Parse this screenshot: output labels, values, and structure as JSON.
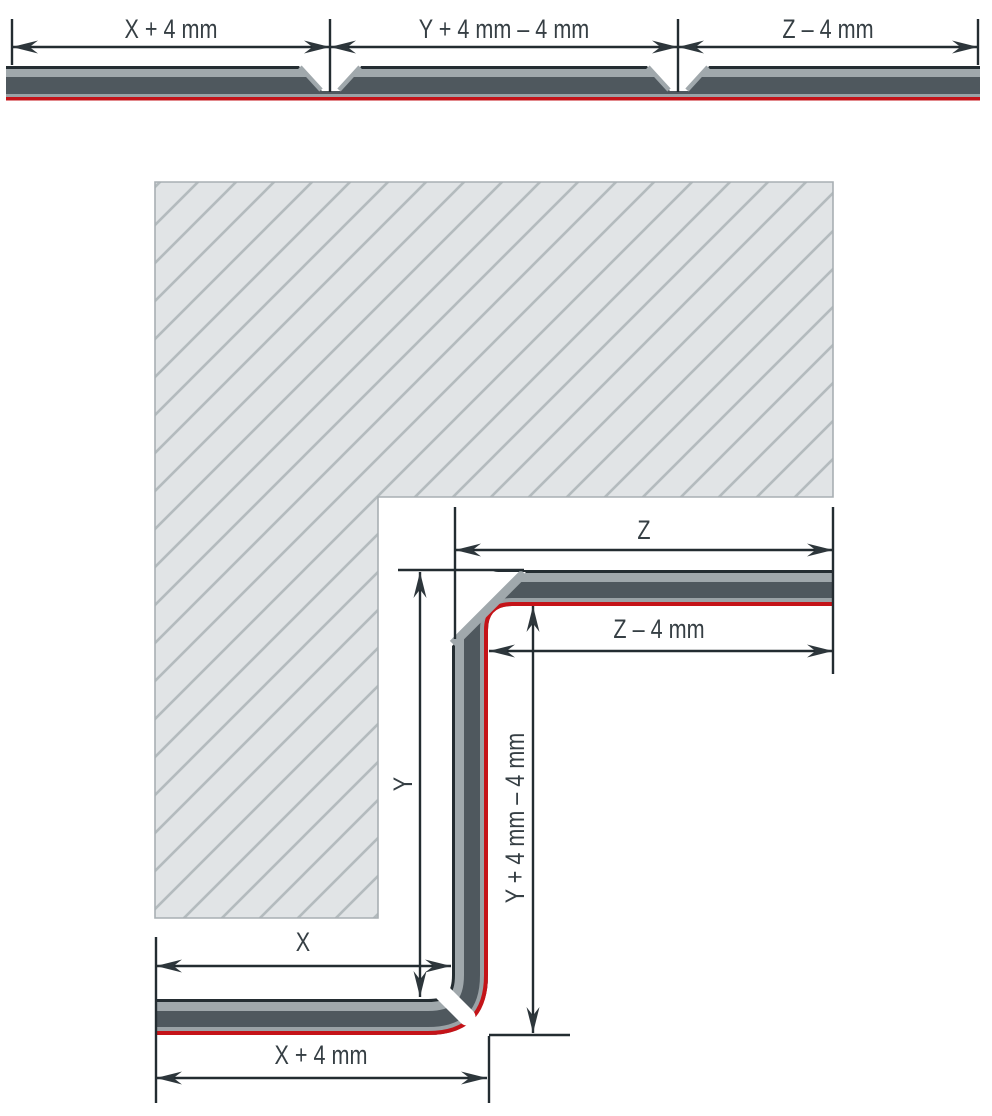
{
  "colors": {
    "background": "#ffffff",
    "panel_outline": "#242d32",
    "panel_dark": "#4f585e",
    "panel_light": "#a0a8ac",
    "panel_light_inner": "#9aa2a6",
    "foil_red": "#c41318",
    "hatch_fill": "#e1e4e6",
    "hatch_line": "#b4bbbe",
    "hatch_border": "#a8afb3",
    "dim_line": "#232c31",
    "label_text": "#363f44"
  },
  "flat_strip": {
    "segments": [
      {
        "label": "X + 4 mm"
      },
      {
        "label": "Y + 4 mm – 4 mm"
      },
      {
        "label": "Z – 4 mm"
      }
    ]
  },
  "corner_profile": {
    "labels": {
      "z": "Z",
      "z_minus_4mm": "Z – 4 mm",
      "y": "Y",
      "y_plus_4mm_minus_4mm": "Y + 4 mm – 4 mm",
      "x": "X",
      "x_plus_4mm": "X + 4 mm"
    }
  }
}
